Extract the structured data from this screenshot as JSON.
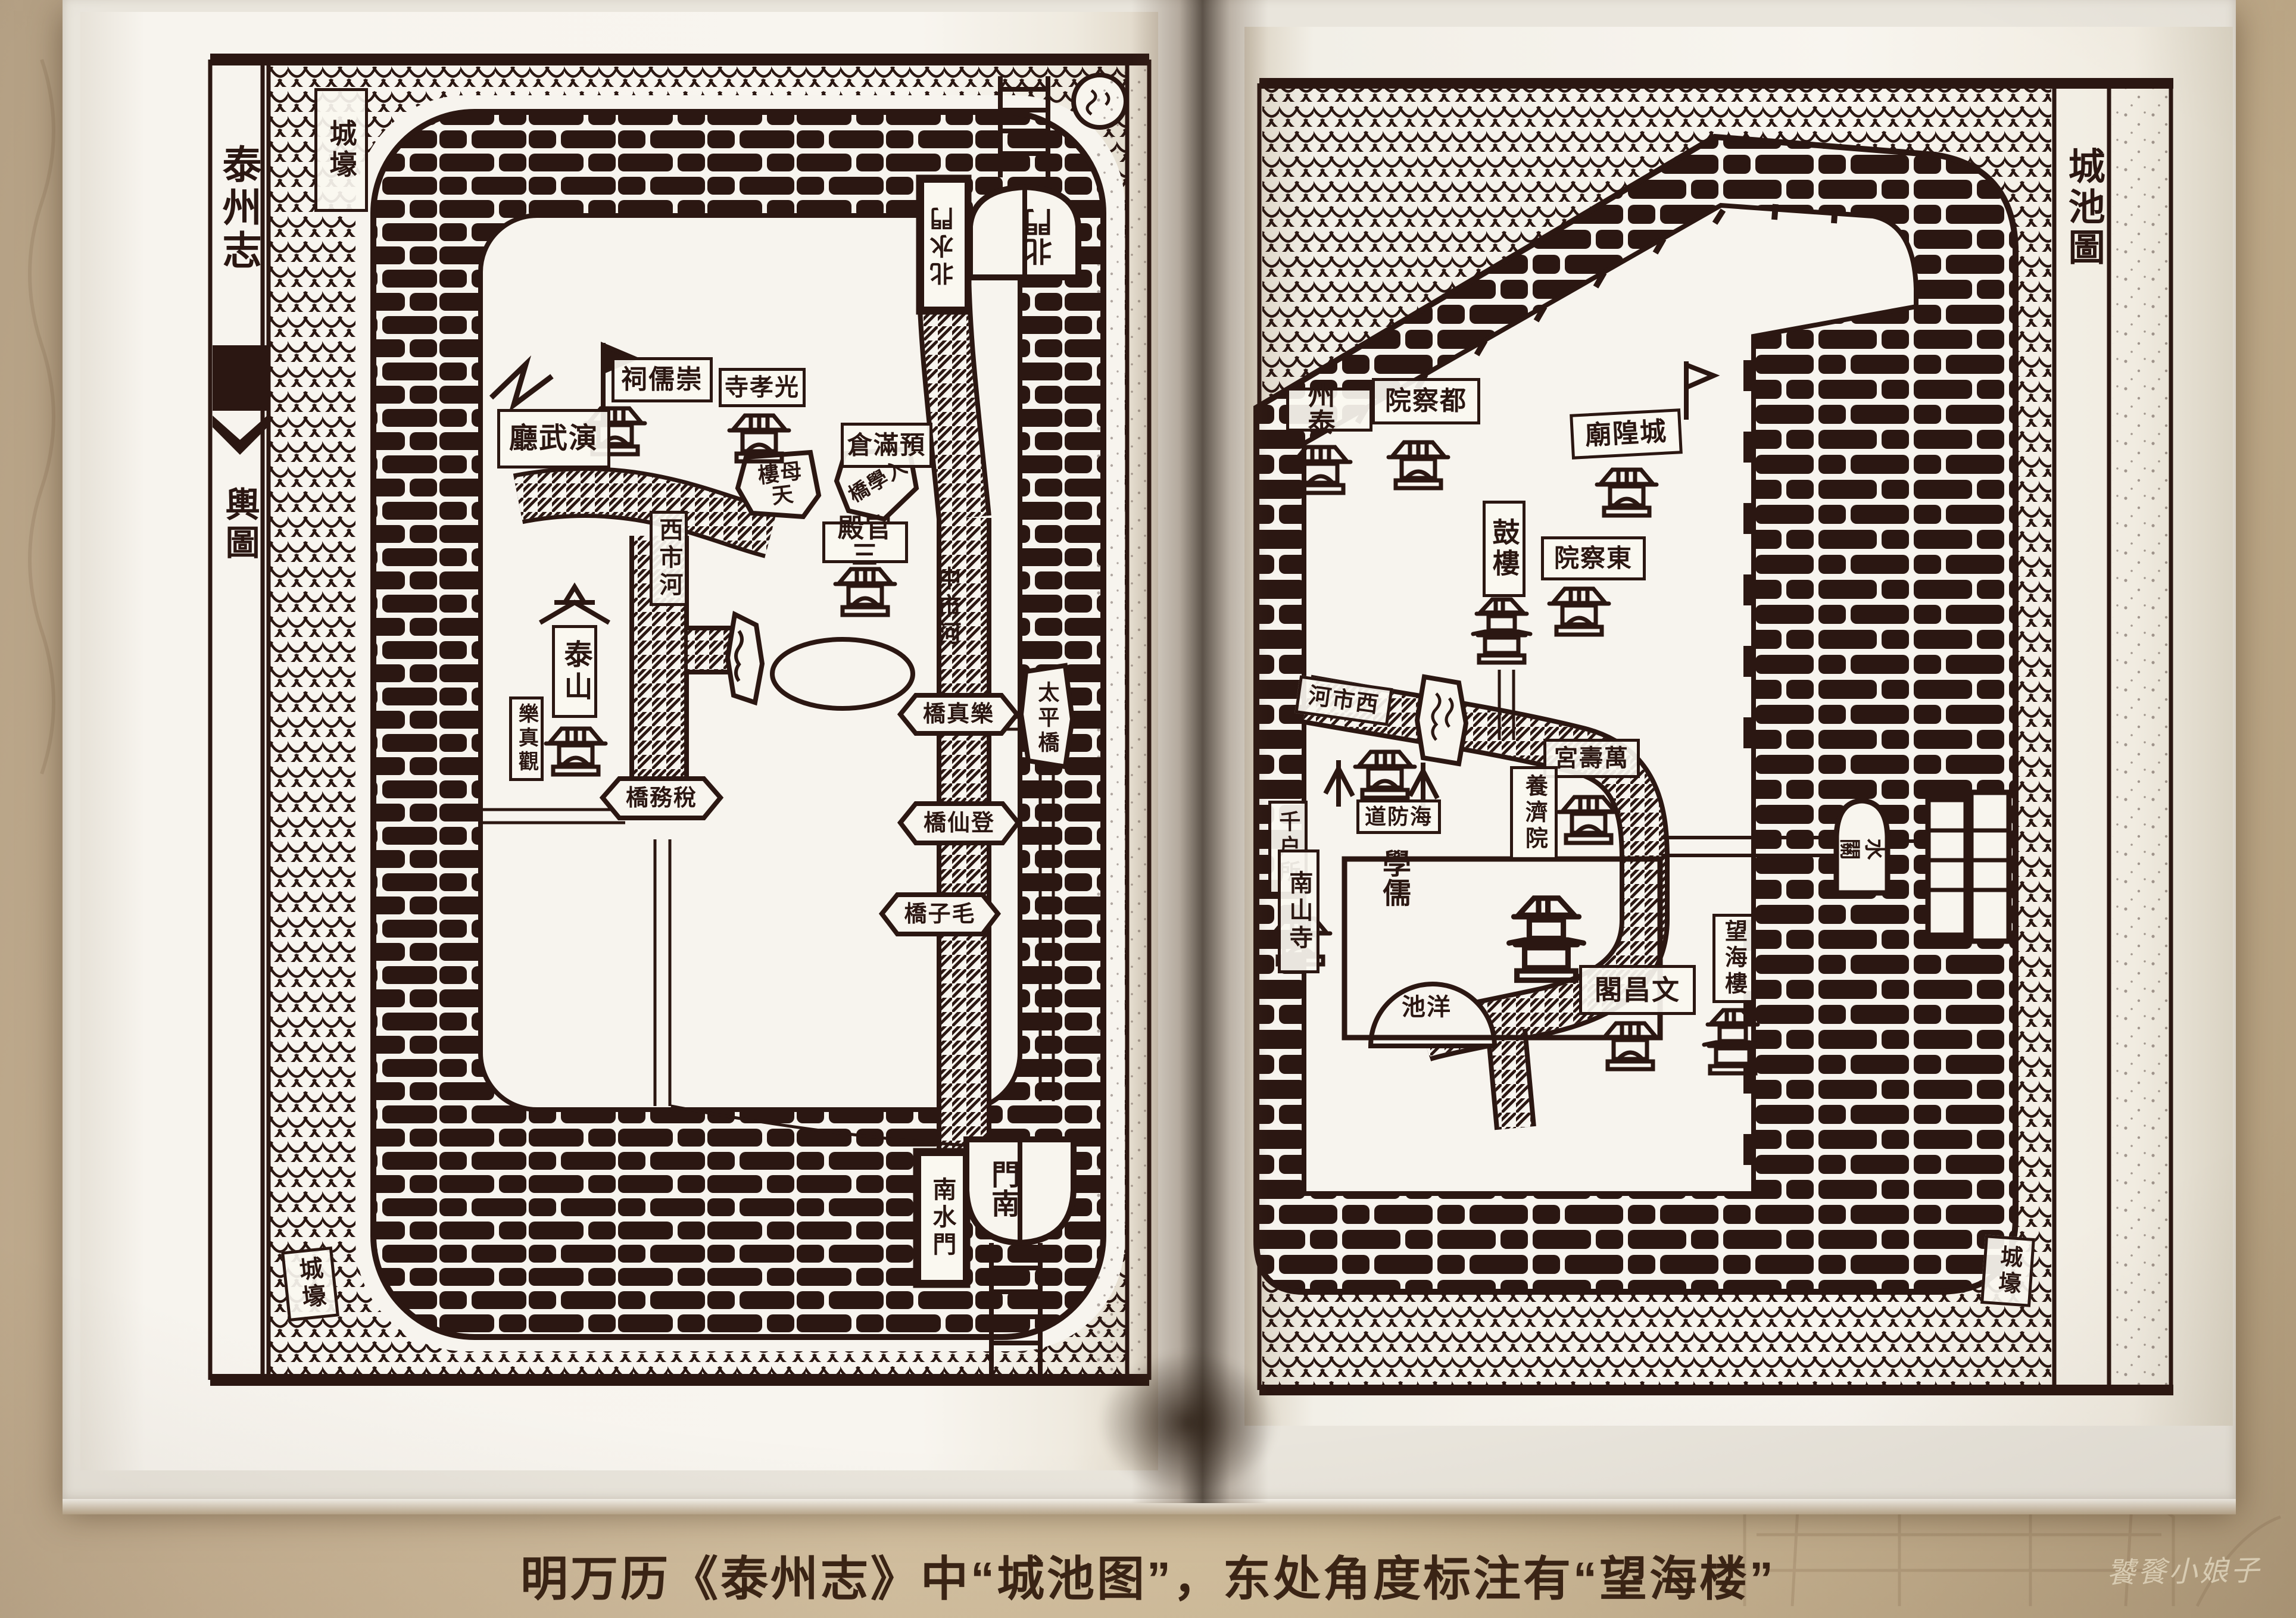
{
  "photo": {
    "caption": "明万历《泰州志》中“城池图”，东处角度标注有“望海楼”",
    "watermark": "饕餮小娘子"
  },
  "colors": {
    "ink": "#2b1712",
    "page": "#f6f3ec",
    "wall_background": "#c9b393",
    "caption_text": "#3a2415",
    "watermark_text": "#eadfc6"
  },
  "left_page": {
    "book_title": "泰州志",
    "map_title": "輿圖",
    "labels": {
      "moat_top": "城壕",
      "moat_bottom": "城壕",
      "north_water_gate": "北水門",
      "north_gate": "北門",
      "south_water_gate": "南水門",
      "south_gate": "南門",
      "yanwu_hall": "演武廳",
      "chongru_shrine": "崇儒祠",
      "guangxiao_temple": "光孝寺",
      "granary": "預滿倉",
      "tianmu_tower": "天母樓",
      "ruxue_bridge": "入學橋",
      "sanguan_hall": "三官殿",
      "west_market_river": "西市河",
      "middle_market_river": "中市河",
      "taishan": "泰山",
      "lezhen_temple": "樂真觀",
      "shuiwu_bridge": "稅務橋",
      "lezhen_bridge": "樂真橋",
      "dengxian_bridge": "登仙橋",
      "maozi_bridge": "毛子橋",
      "taiping_bridge": "太平橋"
    }
  },
  "right_page": {
    "map_title": "城池圖",
    "labels": {
      "moat": "城壕",
      "prefecture": "泰州",
      "censorate": "都察院",
      "city_god_temple": "城隍廟",
      "drum_tower": "鼓樓",
      "east_censorate": "東察院",
      "west_market_river": "西市河",
      "wanshou_palace": "萬壽宮",
      "yangji_almshouse": "養濟院",
      "coastal_defense_circuit": "海防道",
      "qianhu_office": "千户所",
      "nanshan_temple": "南山寺",
      "confucian_school": "儒學",
      "wanghai_tower": "望海樓",
      "wenchang_pavilion": "文昌閣",
      "yang_pond": "洋池",
      "water_gate": "水關"
    }
  }
}
